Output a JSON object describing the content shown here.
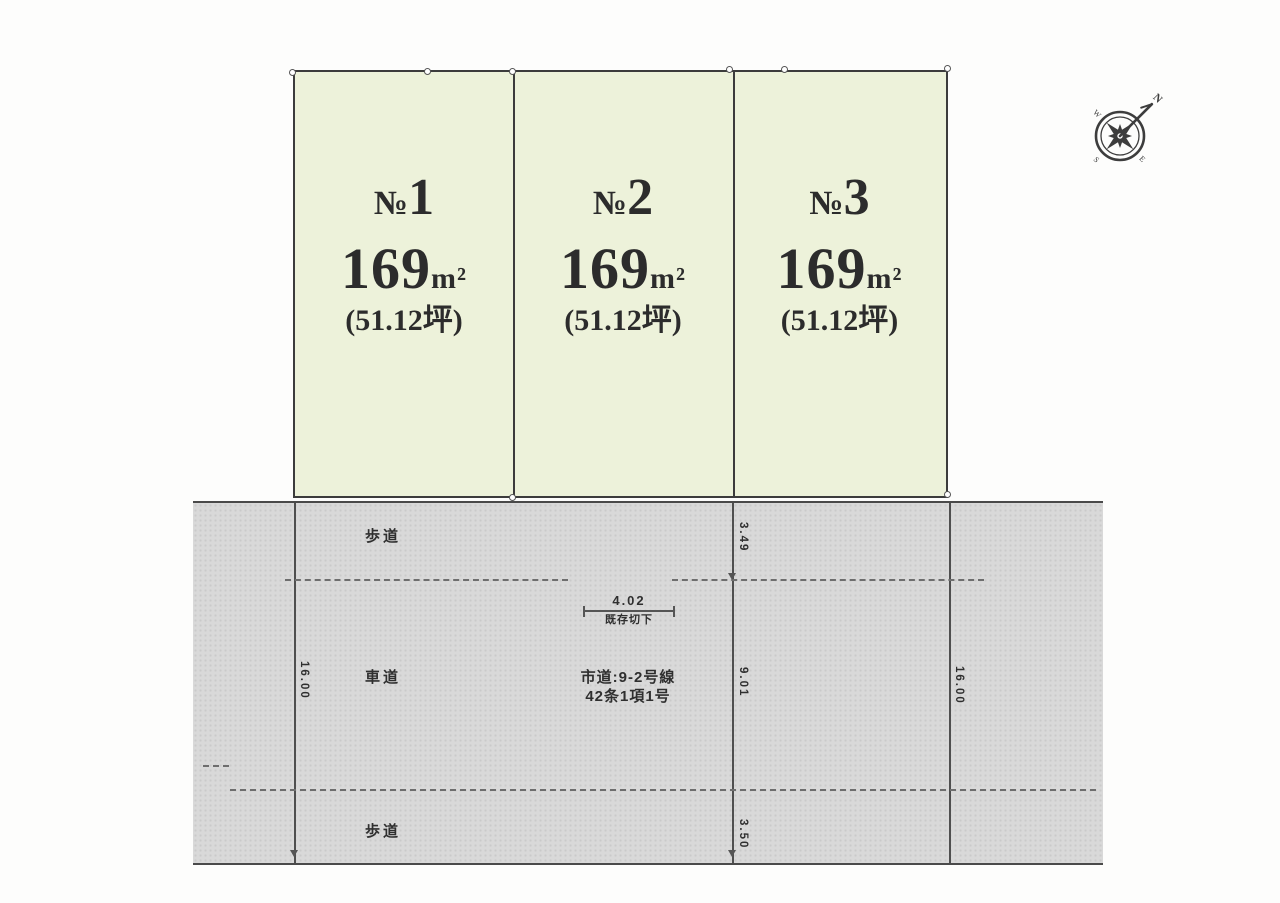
{
  "diagram": {
    "type": "land-lot-subdivision-plan",
    "colors": {
      "lot_fill": "#edf2da",
      "lot_border": "#3c3c3c",
      "road_fill": "#d9d9d9",
      "line": "#4f4f4f",
      "text": "#2c2c2c"
    },
    "lots": [
      {
        "prefix": "№",
        "number": "1",
        "area": "169",
        "area_unit": "m²",
        "tsubo": "(51.12坪)"
      },
      {
        "prefix": "№",
        "number": "2",
        "area": "169",
        "area_unit": "m²",
        "tsubo": "(51.12坪)"
      },
      {
        "prefix": "№",
        "number": "3",
        "area": "169",
        "area_unit": "m²",
        "tsubo": "(51.12坪)"
      }
    ],
    "road": {
      "sidewalk_top": "歩道",
      "roadway": "車道",
      "sidewalk_bottom": "歩道",
      "name_line1": "市道:9-2号線",
      "name_line2": "42条1項1号",
      "curb_cut_width": "4.02",
      "curb_cut_label": "既存切下",
      "dim_sidewalk_top": "3.49",
      "dim_roadway": "9.01",
      "dim_sidewalk_bottom": "3.50",
      "dim_total_left": "16.00",
      "dim_total_right": "16.00"
    },
    "compass": {
      "north": "N",
      "east": "E",
      "south": "S",
      "west": "W"
    }
  }
}
